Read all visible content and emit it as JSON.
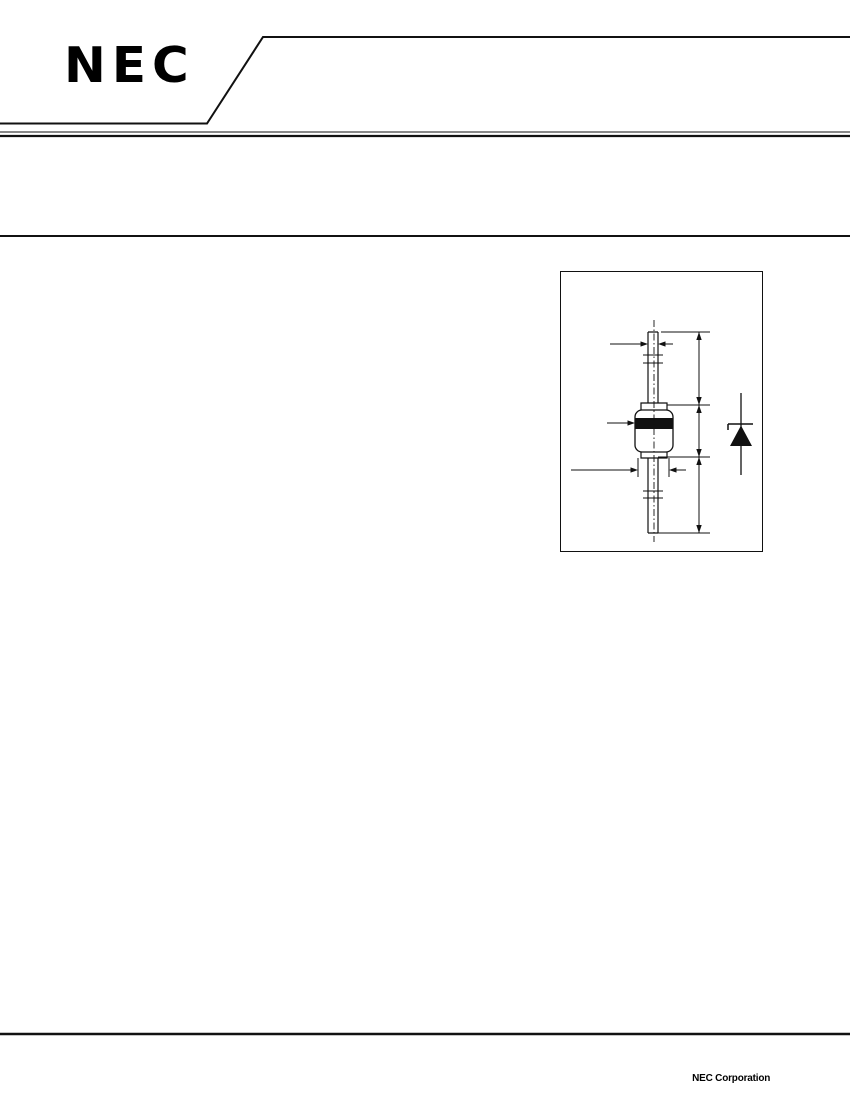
{
  "page": {
    "background": "#ffffff",
    "ink": "#111111"
  },
  "header": {
    "logo_text": "NEC",
    "banner_shape": "angled-banner-outline"
  },
  "figure": {
    "content": "axial-lead diode package outline drawing with dimension arrows",
    "icons": {
      "package": "diode-package-outline-drawing",
      "symbol": "diode-schematic-symbol"
    },
    "cathode_band_color": "#111111"
  },
  "footer": {
    "company": "NEC Corporation"
  }
}
